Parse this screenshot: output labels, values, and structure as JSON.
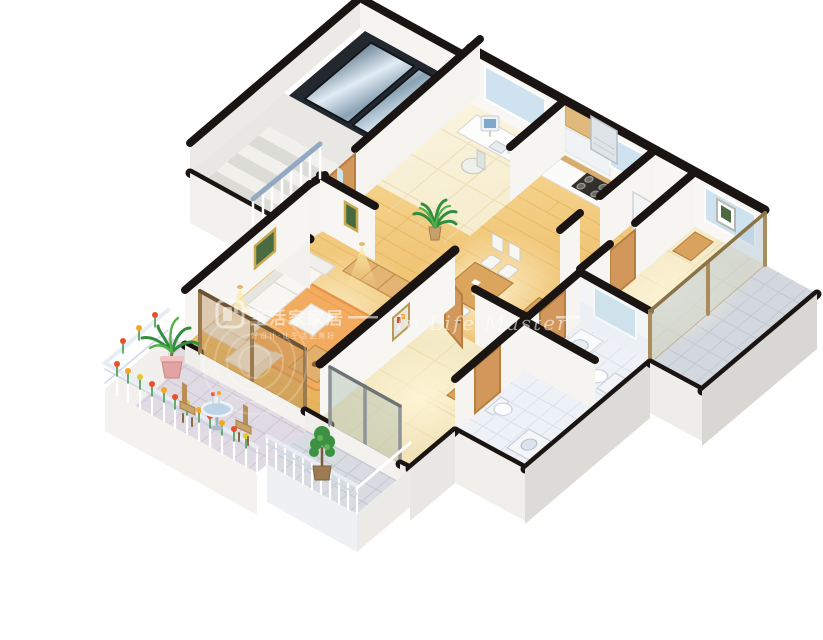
{
  "canvas": {
    "width": 823,
    "height": 640,
    "background": "#ffffff"
  },
  "watermark": {
    "logo": "rounded-square-home-logo",
    "brand": "生活家家居",
    "tagline": "好设计·让生活更美好",
    "script": "In Life Master",
    "color": "#ffffff",
    "opacity": 0.55
  },
  "palette": {
    "wall_top": "#1a1512",
    "wall_face": "#f6f5f1",
    "wall_face_shadow": "#d8d7d3",
    "wood_floor": "#eec06a",
    "pale_floor": "#f5ecca",
    "bath_tile": "#eef1f6",
    "balcony_tile": "#e0dae3",
    "glass_blue": "#b9c9d8",
    "glass_brown": "#b98e57",
    "elevator_metal": "#8aa2b4",
    "door_wood": "#d2975a",
    "furniture_wood": "#d9a35f",
    "sofa_white": "#f7f6f2",
    "rug_orange": "#f3ac5f",
    "plant_green": "#3f9142",
    "flower_red": "#e8502c",
    "flower_orange": "#f5a623",
    "pot_pink": "#e2a3a3",
    "railing_white": "#ffffff",
    "handrail_blue": "#93a9c2",
    "light_glow": "#ffe9a0"
  },
  "scene": {
    "type": "isometric-cutaway-floorplan",
    "description": "3D dollhouse-style vector floor plan of an apartment",
    "rooms": [
      {
        "name": "stairwell-elevator",
        "items": [
          "elevator-doors",
          "staircase",
          "handrail",
          "landing"
        ]
      },
      {
        "name": "study",
        "items": [
          "computer-desk",
          "desktop-computer",
          "office-chair",
          "window",
          "desk-plant"
        ]
      },
      {
        "name": "kitchen",
        "items": [
          "counter",
          "gas-stove",
          "sink",
          "range-hood",
          "upper-cabinets",
          "refrigerator"
        ]
      },
      {
        "name": "dining-area",
        "items": [
          "dining-table",
          "four-chairs",
          "shelf-unit",
          "potted-palm"
        ]
      },
      {
        "name": "living-room",
        "items": [
          "sofa-set",
          "armchair",
          "ottoman",
          "coffee-table",
          "sideboard",
          "rug",
          "wall-art",
          "wall-lamps"
        ]
      },
      {
        "name": "main-balcony",
        "items": [
          "flower-railing",
          "round-glass-table",
          "two-chairs",
          "potted-palm"
        ]
      },
      {
        "name": "bedroom-2",
        "items": [
          "wardrobe",
          "wall-art",
          "open-door",
          "glass-doors"
        ]
      },
      {
        "name": "bedroom-2-balcony",
        "items": [
          "railing",
          "potted-ficus"
        ]
      },
      {
        "name": "bathroom-1",
        "items": [
          "washbasin",
          "toilet",
          "mirror"
        ]
      },
      {
        "name": "bathroom-2",
        "items": [
          "toilet",
          "washing-machine"
        ]
      },
      {
        "name": "bedroom-3",
        "items": [
          "window",
          "cabinet"
        ]
      },
      {
        "name": "bedroom-3-balcony",
        "items": [
          "glass-doors",
          "tile-floor"
        ]
      }
    ]
  }
}
